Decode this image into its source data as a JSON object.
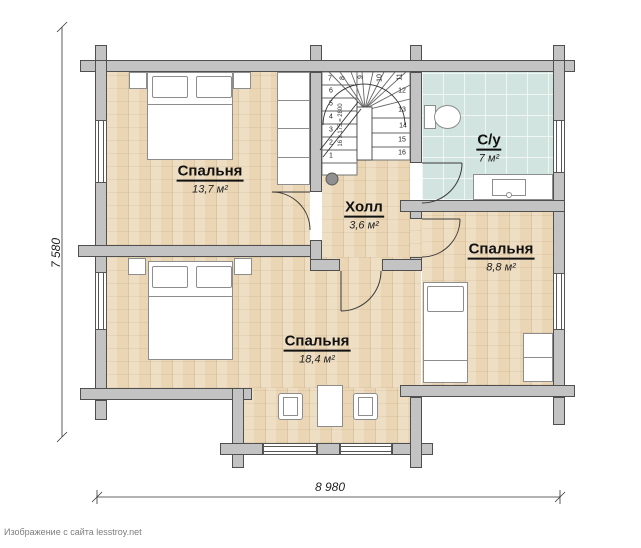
{
  "plan": {
    "rooms": {
      "bedroom_top": {
        "name": "Спальня",
        "area": "13,7 м²"
      },
      "bedroom_bottom": {
        "name": "Спальня",
        "area": "18,4 м²"
      },
      "bedroom_small": {
        "name": "Спальня",
        "area": "8,8 м²"
      },
      "hall": {
        "name": "Холл",
        "area": "3,6 м²"
      },
      "bathroom": {
        "name": "С/у",
        "area": "7 м²"
      }
    },
    "stairs": {
      "formula": "16 х 175 = 2800",
      "step_numbers": [
        "1",
        "2",
        "3",
        "4",
        "5",
        "6",
        "7",
        "8",
        "9",
        "10",
        "11",
        "12",
        "13",
        "14",
        "15",
        "16"
      ]
    },
    "dimensions": {
      "width": "8 980",
      "height": "7 580"
    },
    "watermark": "Изображение с сайта lesstroy.net",
    "colors": {
      "wall": "#c3c3c3",
      "wood_floor": "#ead6b5",
      "tile_floor": "#d2e4df",
      "outline": "#4f4f4f"
    }
  }
}
